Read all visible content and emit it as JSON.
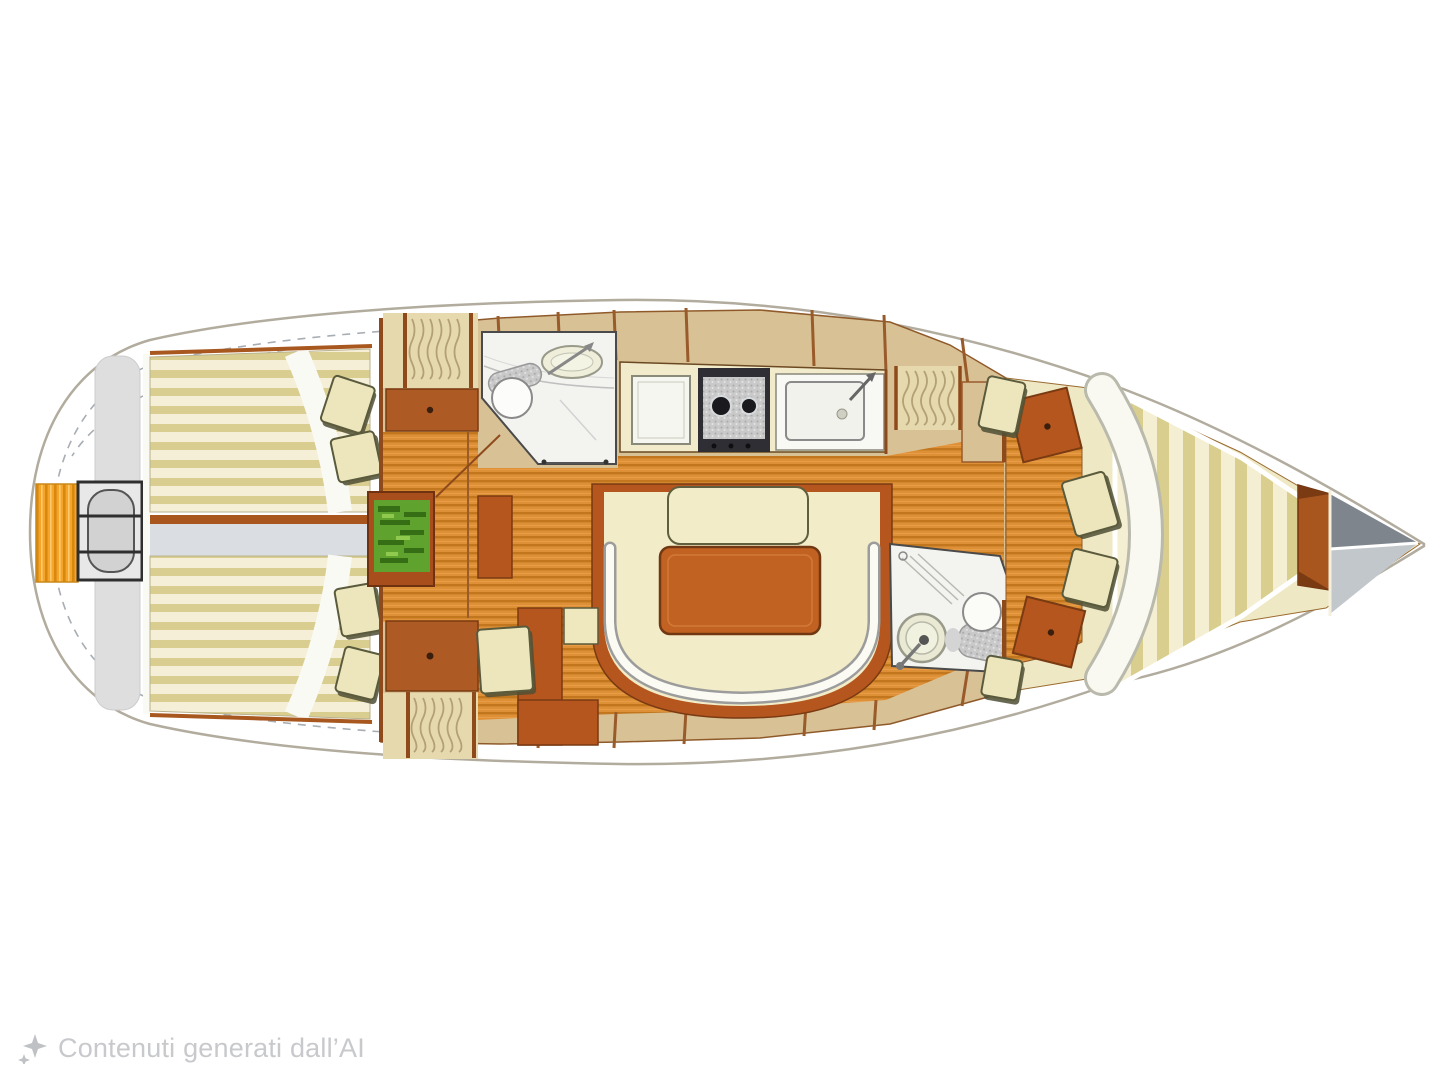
{
  "figure": {
    "type": "yacht-interior-floor-plan",
    "orientation": "bow-right",
    "regions": [
      "transom-step",
      "helm-station",
      "cockpit-bench-starboard",
      "cockpit-bench-port",
      "cockpit-walkway",
      "aft-cabin-starboard",
      "aft-cabin-port",
      "chart-table",
      "aft-head",
      "galley",
      "salon-table",
      "salon-settee",
      "companionway-steps",
      "forward-head",
      "wardrobe-lockers",
      "v-berth",
      "anchor-locker"
    ]
  },
  "watermark": {
    "icon": "ai-sparkle-icon",
    "text": "Contenuti generati dall’AI"
  },
  "palette": {
    "bg": "#ffffff",
    "hull-stroke": "#b2ac9e",
    "deck-tan": "#d9c196",
    "bow-cream": "#efe8c4",
    "wood-base": "#de9036",
    "wood-line": "#c2771f",
    "bench-cream": "#f4efd6",
    "bench-khaki": "#d9ce90",
    "cushion": "#ede6bc",
    "cushion-shadow": "#4f4f35",
    "rust": "#b4561e",
    "rust-dark": "#7a3a12",
    "trim-brown": "#9a5b2b",
    "table-wood": "#c26222",
    "chart-green": "#5fa32e",
    "chart-green-dark": "#356e14",
    "transom-orange": "#f6a52b",
    "room-white": "#f3f3f0",
    "appliance-gray": "#2e2e34",
    "walkway-gray": "#dadee3",
    "locker-gray-dark": "#7e858d",
    "locker-gray-light": "#c2c7cc",
    "watermark": "#c7c9cc"
  }
}
